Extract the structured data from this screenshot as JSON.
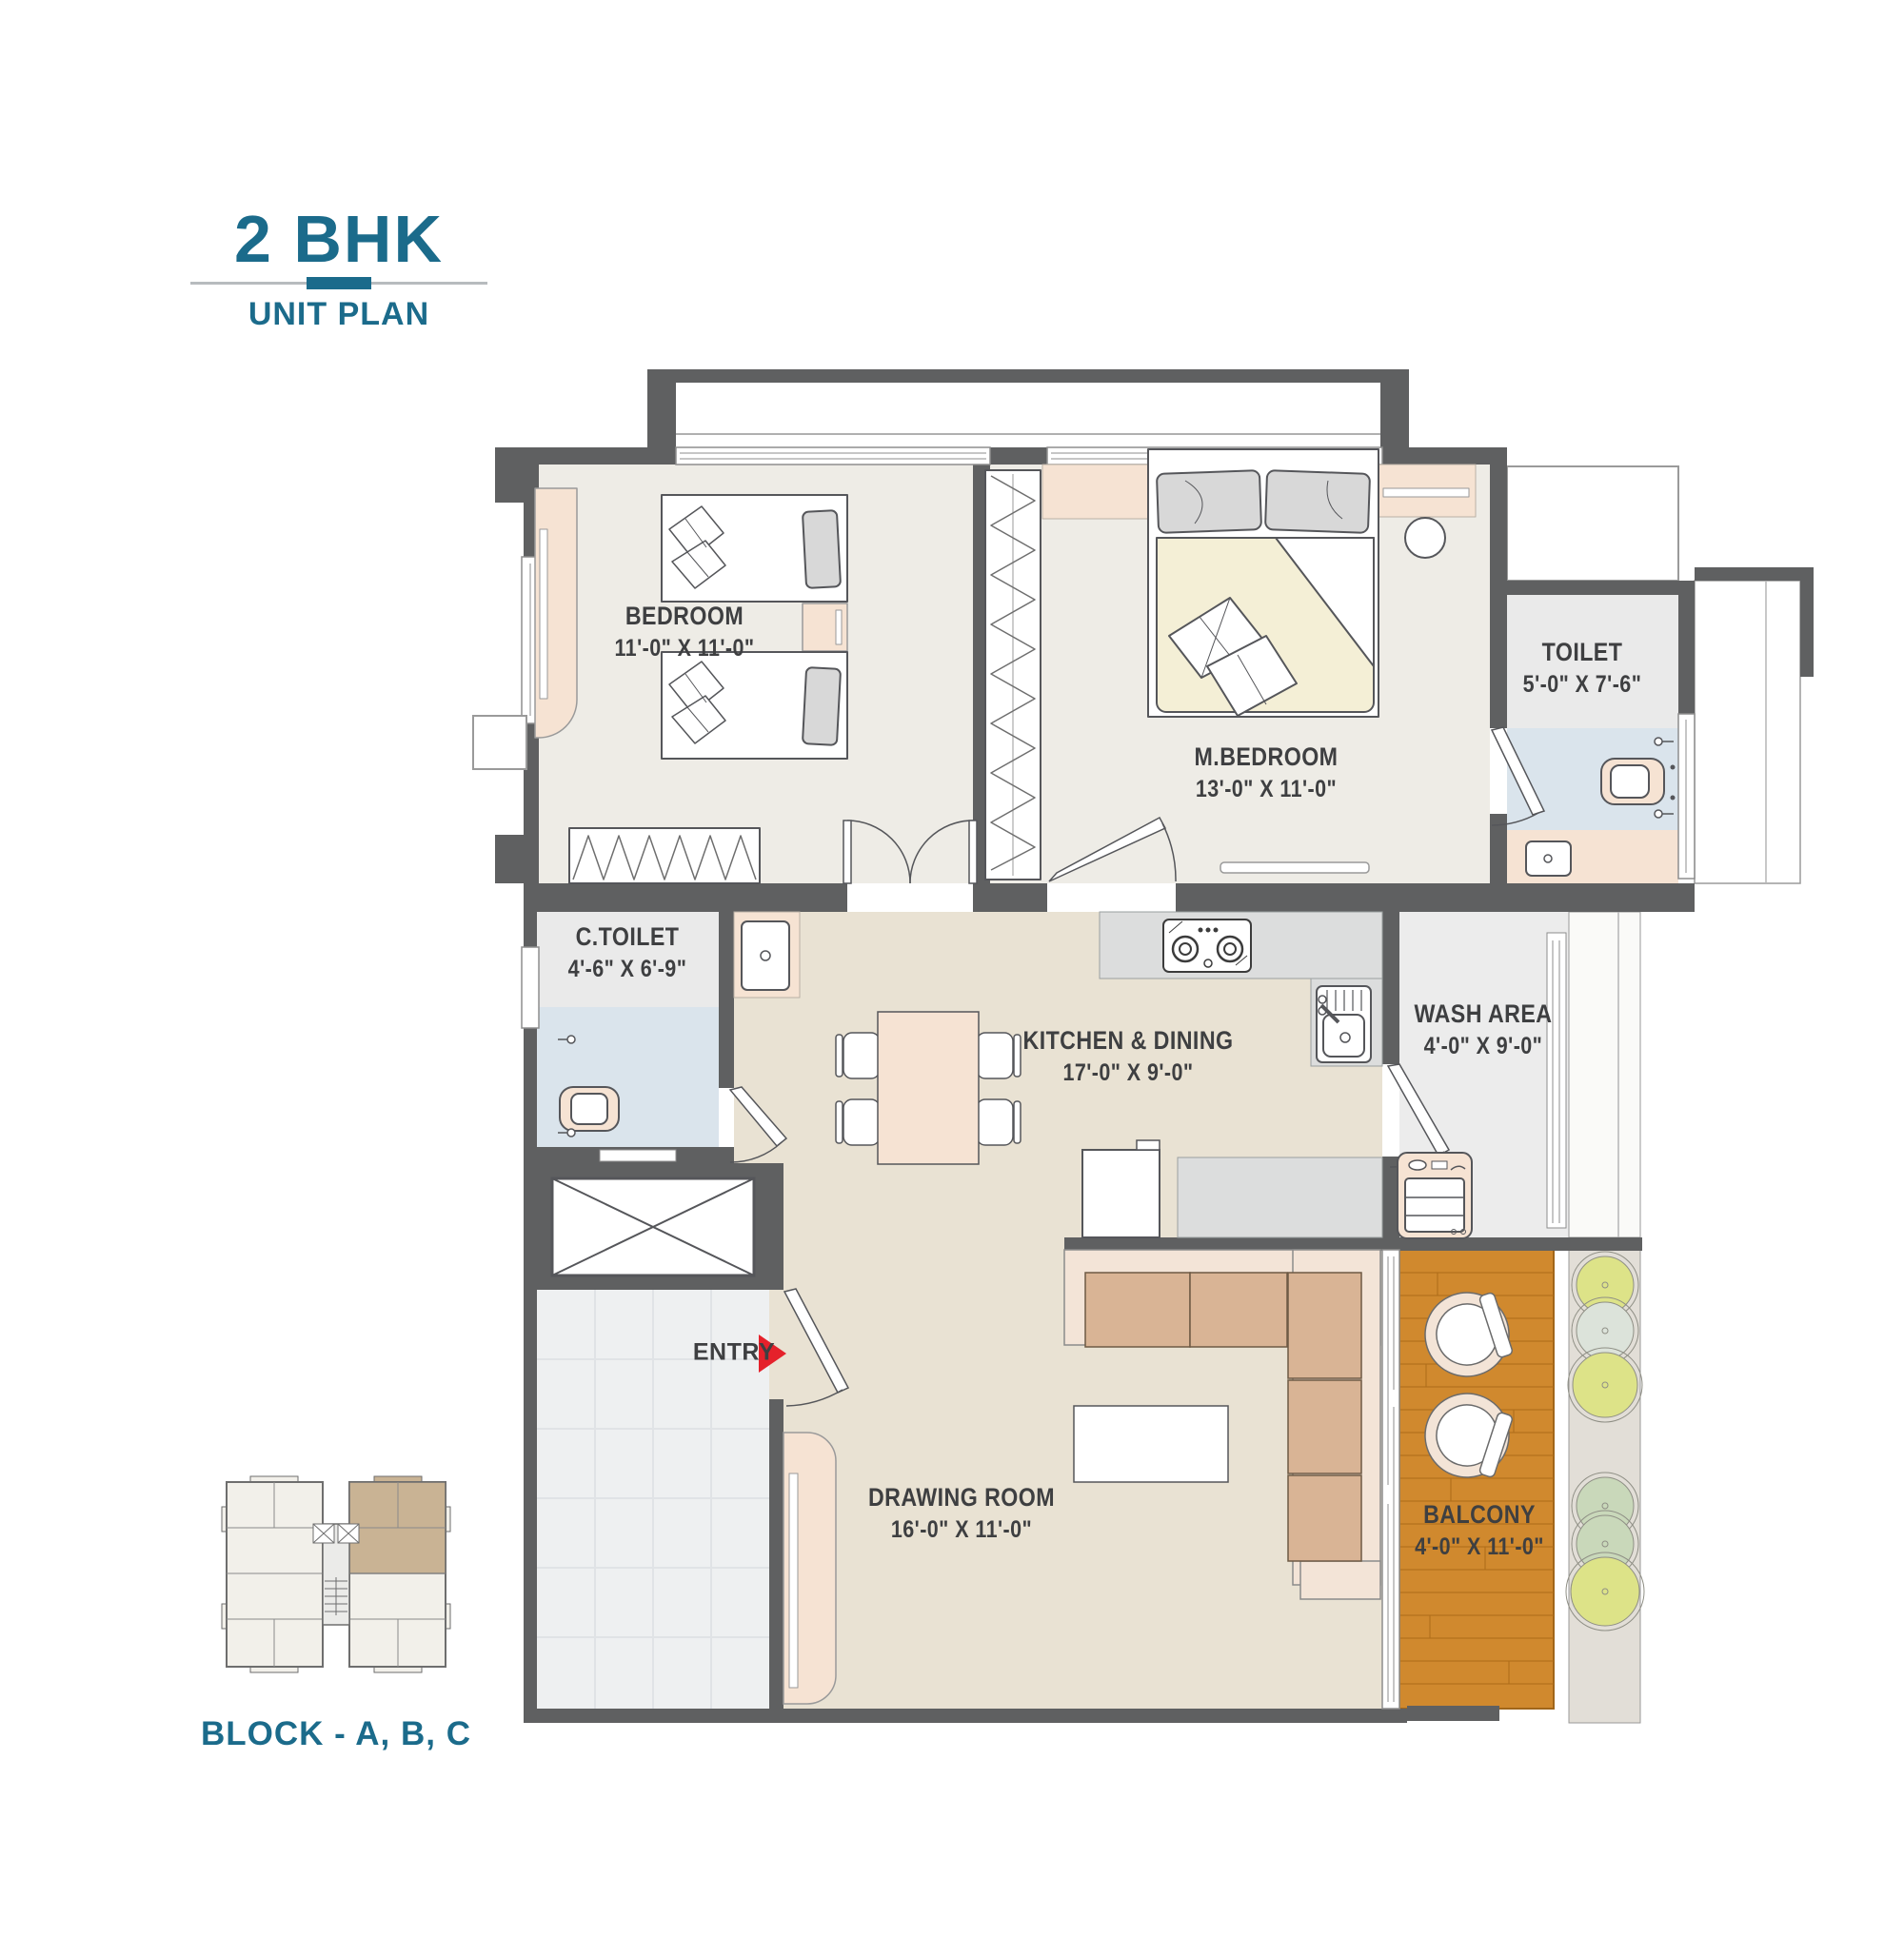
{
  "title": {
    "main": "2 BHK",
    "sub": "UNIT PLAN"
  },
  "key_plan": {
    "caption": "BLOCK - A, B, C"
  },
  "entry": {
    "label": "ENTRY"
  },
  "rooms": {
    "bedroom": {
      "name": "BEDROOM",
      "dims": "11'-0\" X 11'-0\""
    },
    "m_bedroom": {
      "name": "M.BEDROOM",
      "dims": "13'-0\" X 11'-0\""
    },
    "toilet": {
      "name": "TOILET",
      "dims": "5'-0\" X 7'-6\""
    },
    "c_toilet": {
      "name": "C.TOILET",
      "dims": "4'-6\" X 6'-9\""
    },
    "kitchen": {
      "name": "KITCHEN & DINING",
      "dims": "17'-0\" X 9'-0\""
    },
    "wash_area": {
      "name": "WASH AREA",
      "dims": "4'-0\" X 9'-0\""
    },
    "drawing": {
      "name": "DRAWING ROOM",
      "dims": "16'-0\" X 11'-0\""
    },
    "balcony": {
      "name": "BALCONY",
      "dims": "4'-0\" X 11'-0\""
    }
  },
  "colors": {
    "accent_teal": "#1b6b8b",
    "wall": "#5f6061",
    "entry_red": "#e5212b",
    "balcony_wood": "#d0892e",
    "highlight_tan": "#c9b394",
    "peach": "#f6e3d3",
    "wet_blue": "#dae4ec"
  }
}
